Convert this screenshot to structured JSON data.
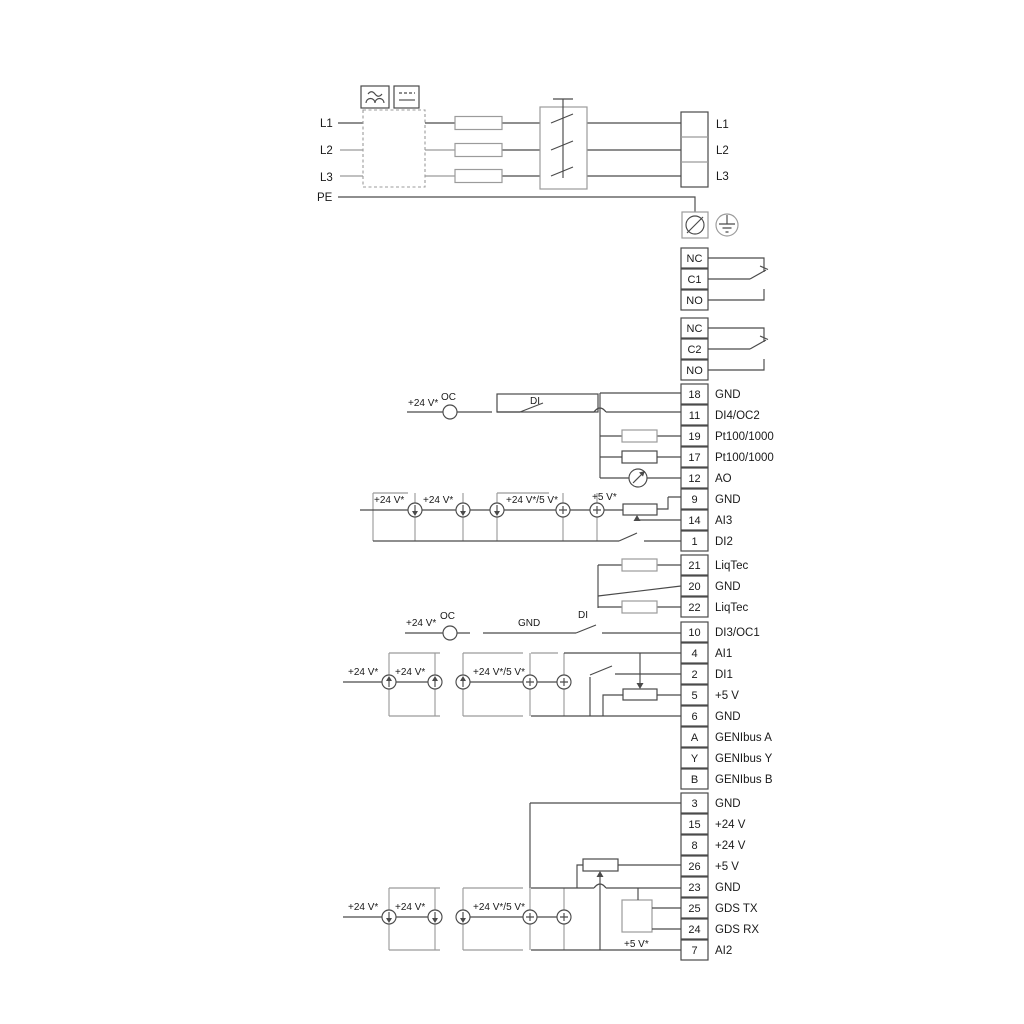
{
  "labels": {
    "l1": "L1",
    "l2": "L2",
    "l3": "L3",
    "pe": "PE",
    "v24": "+24 V*",
    "v24_5": "+24 V*/5 V*",
    "v5s": "+5 V*",
    "oc": "OC",
    "di": "DI",
    "gnd": "GND"
  },
  "power_out": [
    "L1",
    "L2",
    "L3"
  ],
  "relay1": [
    {
      "id": "NC"
    },
    {
      "id": "C1"
    },
    {
      "id": "NO"
    }
  ],
  "relay2": [
    {
      "id": "NC"
    },
    {
      "id": "C2"
    },
    {
      "id": "NO"
    }
  ],
  "io_group1": [
    {
      "id": "18",
      "label": "GND"
    },
    {
      "id": "11",
      "label": "DI4/OC2"
    },
    {
      "id": "19",
      "label": "Pt100/1000"
    },
    {
      "id": "17",
      "label": "Pt100/1000"
    },
    {
      "id": "12",
      "label": "AO"
    },
    {
      "id": "9",
      "label": "GND"
    },
    {
      "id": "14",
      "label": "AI3"
    },
    {
      "id": "1",
      "label": "DI2"
    }
  ],
  "liqtec_group": [
    {
      "id": "21",
      "label": "LiqTec"
    },
    {
      "id": "20",
      "label": "GND"
    },
    {
      "id": "22",
      "label": "LiqTec"
    }
  ],
  "io_group2": [
    {
      "id": "10",
      "label": "DI3/OC1"
    },
    {
      "id": "4",
      "label": "AI1"
    },
    {
      "id": "2",
      "label": "DI1"
    },
    {
      "id": "5",
      "label": "+5 V"
    },
    {
      "id": "6",
      "label": "GND"
    },
    {
      "id": "A",
      "label": "GENIbus A"
    },
    {
      "id": "Y",
      "label": "GENIbus Y"
    },
    {
      "id": "B",
      "label": "GENIbus B"
    }
  ],
  "io_group3": [
    {
      "id": "3",
      "label": "GND"
    },
    {
      "id": "15",
      "label": "+24 V"
    },
    {
      "id": "8",
      "label": "+24 V"
    },
    {
      "id": "26",
      "label": "+5 V"
    },
    {
      "id": "23",
      "label": "GND"
    },
    {
      "id": "25",
      "label": "GDS TX"
    },
    {
      "id": "24",
      "label": "GDS RX"
    },
    {
      "id": "7",
      "label": "AI2"
    }
  ],
  "colors": {
    "wire": "#4a4a4a",
    "frame": "#9b9b9b",
    "text": "#1a1a1a",
    "background": "#ffffff"
  }
}
